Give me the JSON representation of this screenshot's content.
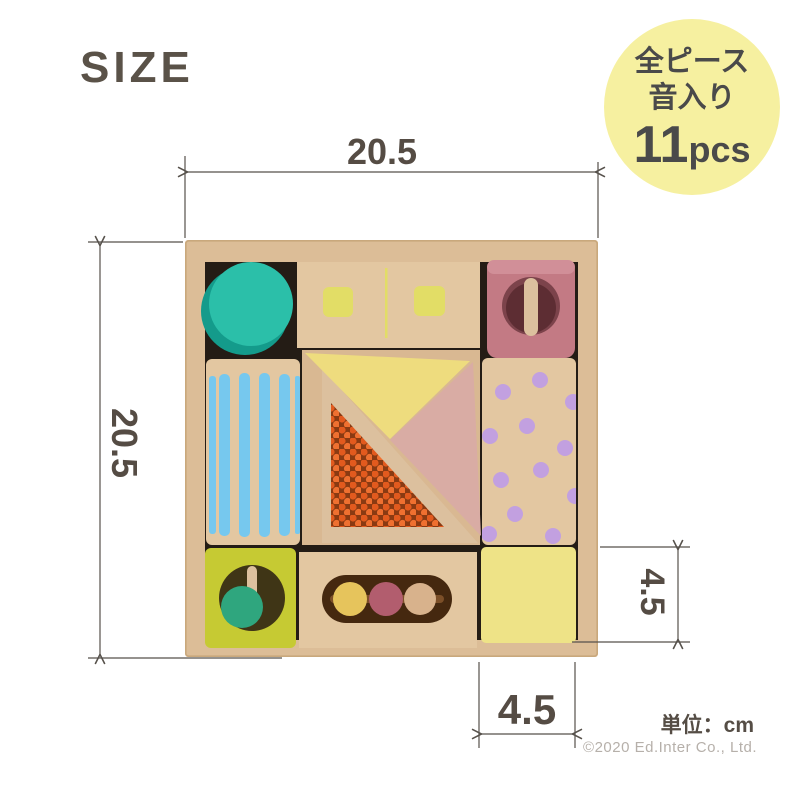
{
  "title": "SIZE",
  "badge": {
    "line1": "全ピース",
    "line2": "音入り",
    "count": "11",
    "count_unit": "pcs",
    "bg_color": "#f6f0a0",
    "text_color": "#4a4a4a"
  },
  "dimensions": {
    "width_label": "20.5",
    "height_label": "20.5",
    "block_height_label": "4.5",
    "block_width_label": "4.5",
    "unit_note": "単位：cm",
    "line_color": "#56514b"
  },
  "footer": {
    "copyright": "©2020 Ed.Inter Co., Ltd."
  },
  "photo": {
    "colors": {
      "box_wood": "#dcbd97",
      "box_wood_edge": "#c9a87c",
      "interior_shadow": "#241c15",
      "wood_light": "#e3c7a1",
      "wood_mid": "#d9b892",
      "dowel_wood": "#dcc09e",
      "teal": "#2bbfa9",
      "teal_dark": "#149b8b",
      "yellow_square": "#e2dd66",
      "mauve": "#c37a84",
      "mauve_top": "#d18f98",
      "mauve_hole": "#7c434b",
      "mauve_hole_dark": "#5d2d33",
      "blue_stripe": "#76c8ee",
      "tri_yellow": "#eedc7e",
      "tri_pink": "#d9aca4",
      "bead_bg": "#8a3a12",
      "bead_orange": "#e25a1e",
      "bead_orange_light": "#ef7030",
      "dot_purple": "#c2a0e0",
      "chartreuse": "#c6ca33",
      "hole_dark": "#3f3516",
      "ball_green": "#2fa67e",
      "rattle_hole": "#45280f",
      "rattle_stick": "#7c4f28",
      "ball_yellow": "#e6c45c",
      "ball_mauve": "#b25d6e",
      "ball_beige": "#d8b28c",
      "pale_yellow": "#eee387"
    }
  }
}
